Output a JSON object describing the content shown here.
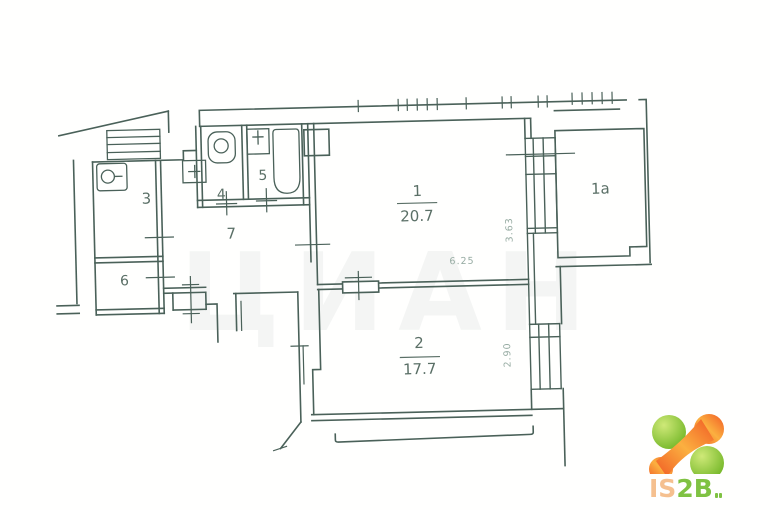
{
  "plan": {
    "watermark": "ЦИАН",
    "rooms": [
      {
        "number": "1",
        "area": "20.7"
      },
      {
        "number": "2",
        "area": "17.7"
      },
      {
        "number": "1a"
      },
      {
        "number": "3"
      },
      {
        "number": "4"
      },
      {
        "number": "5"
      },
      {
        "number": "6"
      },
      {
        "number": "7"
      }
    ],
    "dimensions": {
      "room1_width": "6.25",
      "window_1_height": "3.63",
      "window_2_height": "2.90"
    },
    "line_color": "#4a6159",
    "label_color": "#5a6f66",
    "dimension_color": "#96aba2"
  },
  "logo": {
    "text_is": "IS",
    "text_2b": "2B",
    "color_is": "#f5c08f",
    "color_2b": "#7fc242",
    "color_green": "#76b82a",
    "color_orange": "#f15a24"
  }
}
